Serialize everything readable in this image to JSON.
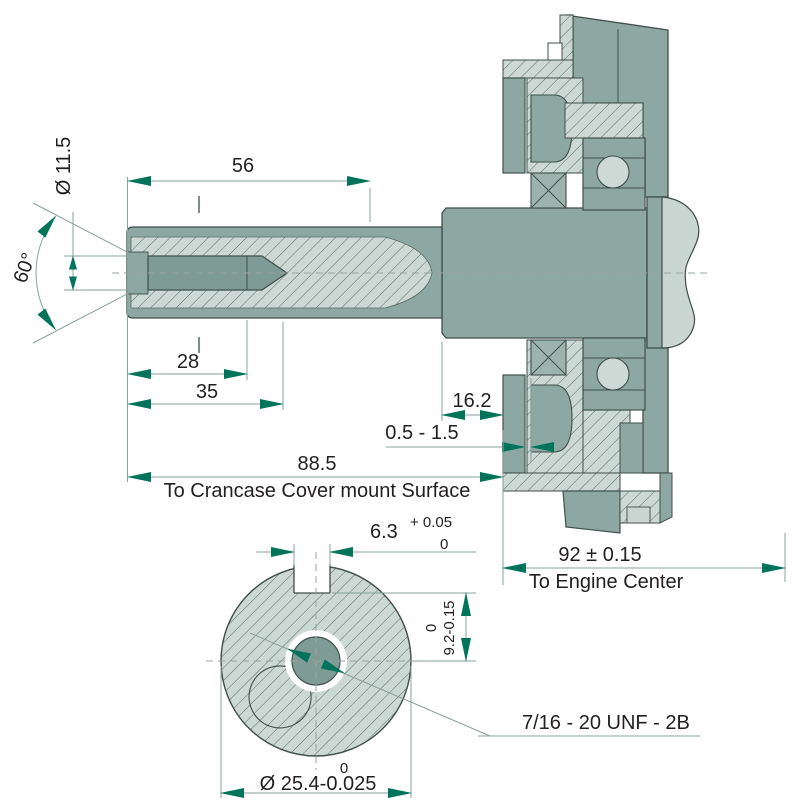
{
  "drawing": {
    "kind": "crankshaft-section-technical-drawing",
    "colors": {
      "part_teal": "#8DA8A3",
      "part_dark_teal": "#7E9B96",
      "section_fill": "#CBD8D3",
      "highlight_fill": "#C9D6D1",
      "dimension_accent": "#00745A",
      "outline": "#3F4F4B"
    },
    "side_view": {
      "keyway_length": "56",
      "chamfer_dia": "Ø 11.5",
      "chamfer_angle": "60°",
      "thread_depth": "28",
      "hole_depth": "35",
      "mount_face_to_step": "16.2",
      "cover_clearance": "0.5 - 1.5",
      "tip_to_mount": "88.5",
      "tip_to_mount_label": "To Crancase Cover mount Surface",
      "mount_to_engine_center": "92 ± 0.15",
      "engine_center_label": "To Engine Center"
    },
    "end_view": {
      "keyway_width": "6.3",
      "keyway_width_tol_top": "+ 0.05",
      "keyway_width_tol_bottom": "0",
      "keyway_depth": "9.2-0.15",
      "keyway_depth_tol_top": "0",
      "shaft_dia": "Ø 25.4-0.025",
      "shaft_dia_tol_top": "0",
      "center_thread": "7/16 - 20 UNF - 2B"
    }
  }
}
